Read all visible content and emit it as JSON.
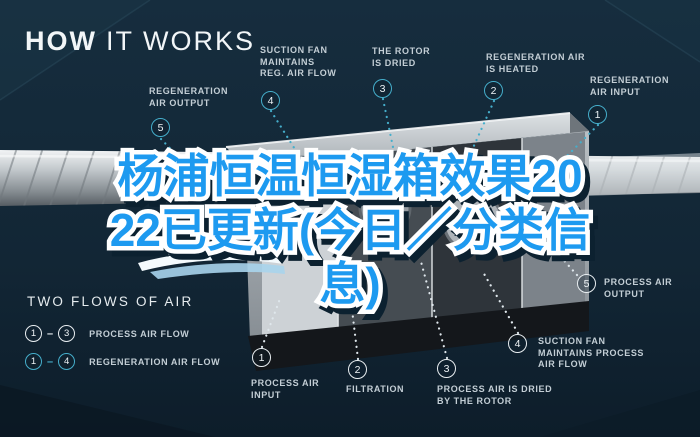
{
  "header": {
    "title_bold": "HOW",
    "title_light": "IT WORKS"
  },
  "overlay": {
    "lines": [
      "杨浦恒温恒湿箱效果20",
      "22已更新(今日／分类信",
      "息)"
    ],
    "text_color": "#1d9af0",
    "outline_color": "#ffffff"
  },
  "callouts": {
    "regeneration": [
      {
        "num": "1",
        "label": "REGENERATION\nAIR INPUT"
      },
      {
        "num": "2",
        "label": "REGENERATION AIR\nIS HEATED"
      },
      {
        "num": "3",
        "label": "THE ROTOR\nIS DRIED"
      },
      {
        "num": "4",
        "label": "SUCTION FAN\nMAINTAINS\nREG. AIR FLOW"
      },
      {
        "num": "5",
        "label": "REGENERATION\nAIR OUTPUT"
      }
    ],
    "process": [
      {
        "num": "1",
        "label": "PROCESS AIR\nINPUT"
      },
      {
        "num": "2",
        "label": "FILTRATION"
      },
      {
        "num": "3",
        "label": "PROCESS AIR IS DRIED\nBY THE ROTOR"
      },
      {
        "num": "4",
        "label": "SUCTION FAN\nMAINTAINS PROCESS\nAIR FLOW"
      },
      {
        "num": "5",
        "label": "PROCESS AIR\nOUTPUT"
      }
    ]
  },
  "legend": {
    "title": "TWO FLOWS OF AIR",
    "rows": [
      {
        "from": "1",
        "to": "3",
        "dash": "–",
        "label": "PROCESS AIR FLOW"
      },
      {
        "from": "1",
        "to": "4",
        "dash": "–",
        "label": "REGENERATION AIR FLOW"
      }
    ]
  },
  "colors": {
    "background": "#13293a",
    "regeneration_accent": "#45aecb",
    "process_accent": "#e9eef1",
    "overlay_blue": "#1d9af0"
  }
}
